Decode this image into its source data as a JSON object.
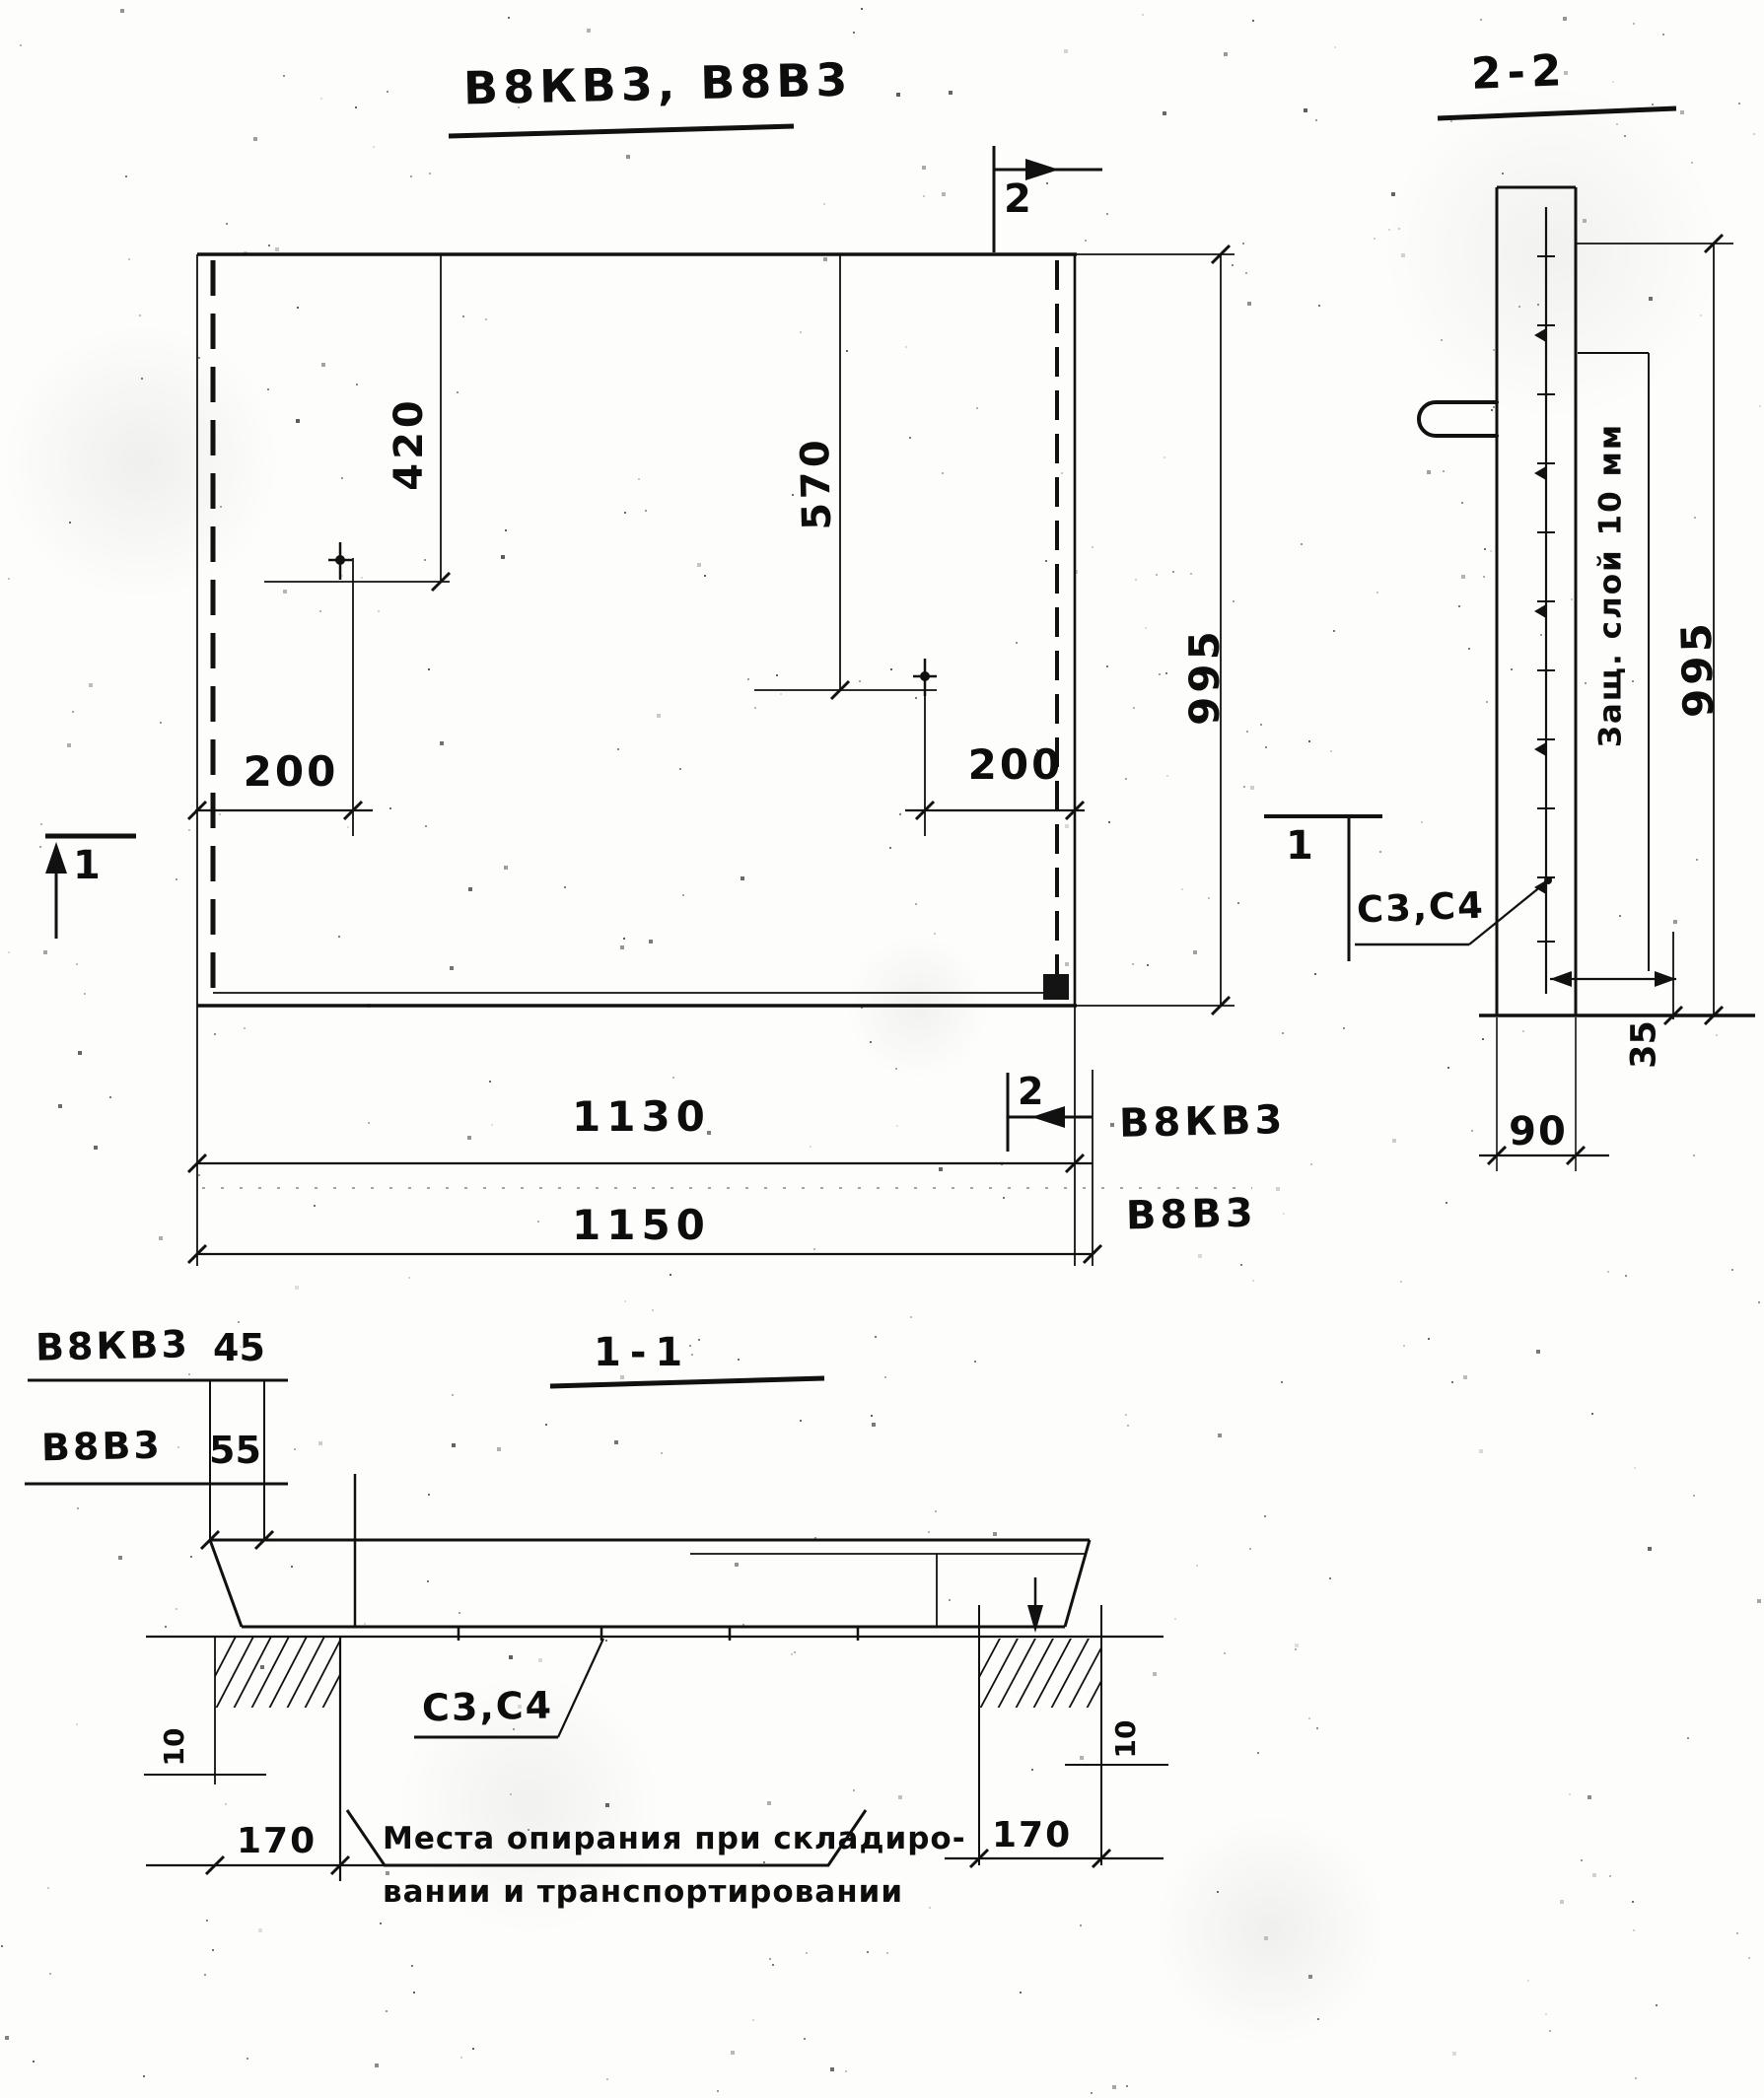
{
  "drawing": {
    "title": "В8КВ3, В8В3",
    "ink_color": "#0d0d0d",
    "plan": {
      "dim_420": "420",
      "dim_570": "570",
      "dim_995": "995",
      "dim_200_left": "200",
      "dim_200_right": "200",
      "length_rows": [
        {
          "value": "1130",
          "label": "В8КВ3"
        },
        {
          "value": "1150",
          "label": "В8В3"
        }
      ],
      "section_mark_2_top": "2",
      "section_mark_2_bottom": "2",
      "section_mark_1_left": "1",
      "section_mark_1_right": "1"
    },
    "section22": {
      "title": "2-2",
      "protective_layer": "Защ. слой 10 мм",
      "dim_995": "995",
      "rebar_label": "С3,С4",
      "dim_35": "35",
      "dim_90": "90"
    },
    "section11": {
      "title": "1-1",
      "edge_rows": [
        {
          "label": "В8КВ3",
          "value": "45"
        },
        {
          "label": "В8В3",
          "value": "55"
        }
      ],
      "rebar_label": "С3,С4",
      "dim_10_left": "10",
      "dim_10_right": "10",
      "dim_170_left": "170",
      "dim_170_right": "170",
      "note_line1": "Места опирания при складиро-",
      "note_line2": "вании и транспортировании"
    }
  }
}
